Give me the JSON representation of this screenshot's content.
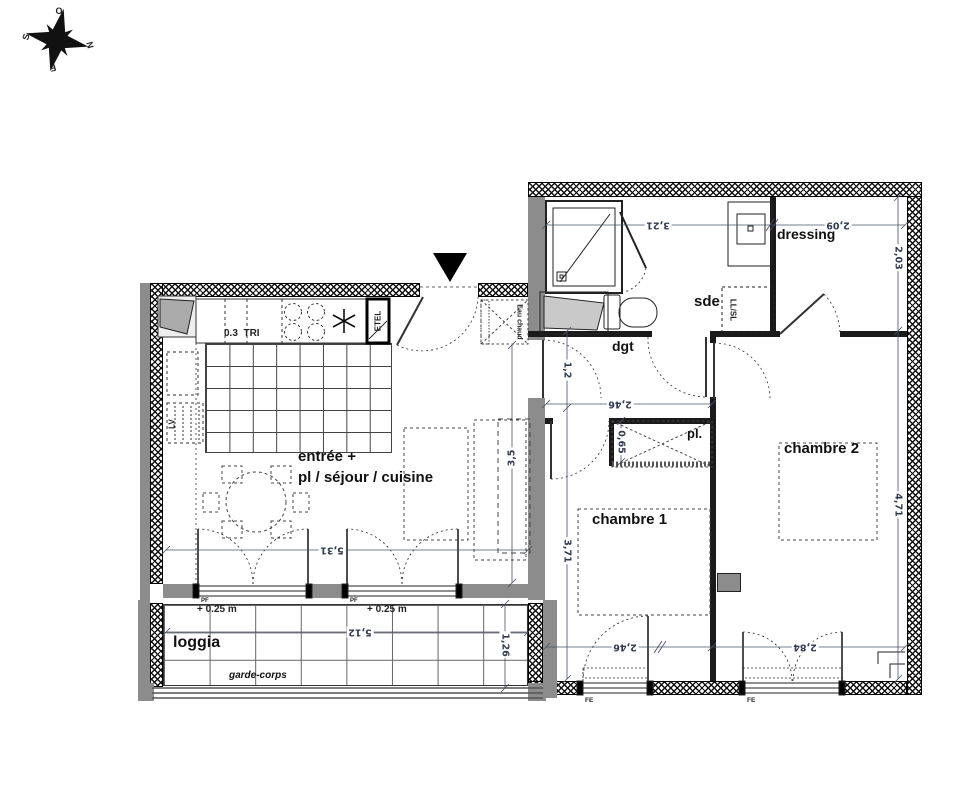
{
  "compass": {
    "o": "O",
    "n": "N",
    "s": "S",
    "e": "E"
  },
  "rooms": {
    "entree_line1": "entrée +",
    "entree_line2": "pl / séjour / cuisine",
    "chambre1": "chambre 1",
    "chambre2": "chambre 2",
    "dressing": "dressing",
    "sde": "sde",
    "dgt": "dgt",
    "placard": "pl.",
    "loggia": "loggia",
    "garde_corps": "garde-corps"
  },
  "labels": {
    "tri_value": "0.3",
    "tri": "TRI",
    "etel": "ETEL",
    "lv": "LV",
    "llsl": "LL/SL",
    "eau_chaude": "Eau chaud",
    "pf1": "PF",
    "pf2": "PF",
    "fe1": "FE",
    "fe2": "FE",
    "level_a": "+ 0.25 m",
    "level_b": "+ 0.25 m"
  },
  "dimensions": {
    "sejour_width": "5,31",
    "sejour_depth": "3,5",
    "sde_width": "3,21",
    "dressing_width": "2,09",
    "dressing_depth": "2,03",
    "dgt_width": "1,2",
    "chambre1_width_top": "2,46",
    "placard_depth": "0,65",
    "chambre1_depth": "3,71",
    "chambre2_depth": "4,71",
    "chambre1_width": "2,46",
    "chambre2_width": "2,84",
    "loggia_width": "5,12",
    "loggia_depth": "1,26"
  }
}
